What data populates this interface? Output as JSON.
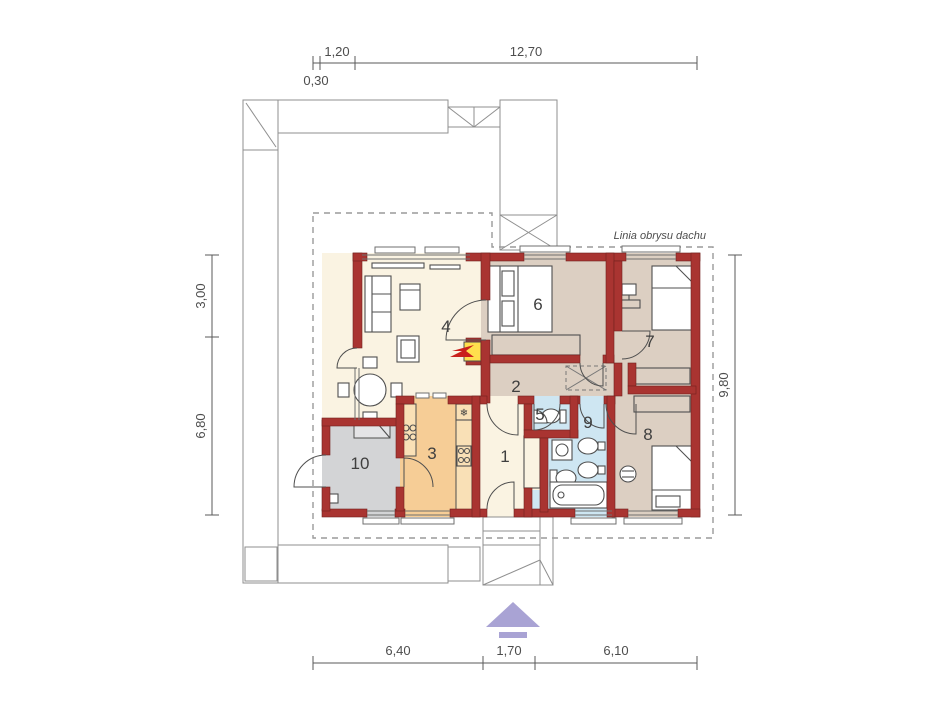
{
  "plan": {
    "roof_label": "Linia obrysu dachu",
    "rooms": {
      "r1": "1",
      "r2": "2",
      "r3": "3",
      "r4": "4",
      "r5": "5",
      "r6": "6",
      "r7": "7",
      "r8": "8",
      "r9": "9",
      "r10": "10"
    },
    "dims": {
      "top_030": "0,30",
      "top_120": "1,20",
      "top_1270": "12,70",
      "left_300": "3,00",
      "left_680": "6,80",
      "right_980": "9,80",
      "bottom_640": "6,40",
      "bottom_170": "1,70",
      "bottom_610": "6,10"
    },
    "icons": {
      "fridge": "❄"
    },
    "colors": {
      "wall": "#a93431",
      "living_floor": "#faf3e2",
      "kitchen_floor": "#f6cd96",
      "counter": "#f9e0b6",
      "bedroom_floor": "#dccfc2",
      "bath_floor": "#cee6f2",
      "utility_floor": "#d3d4d6",
      "fireplace": "#ffdf4d",
      "north_arrow": "#a9a3d4"
    }
  }
}
